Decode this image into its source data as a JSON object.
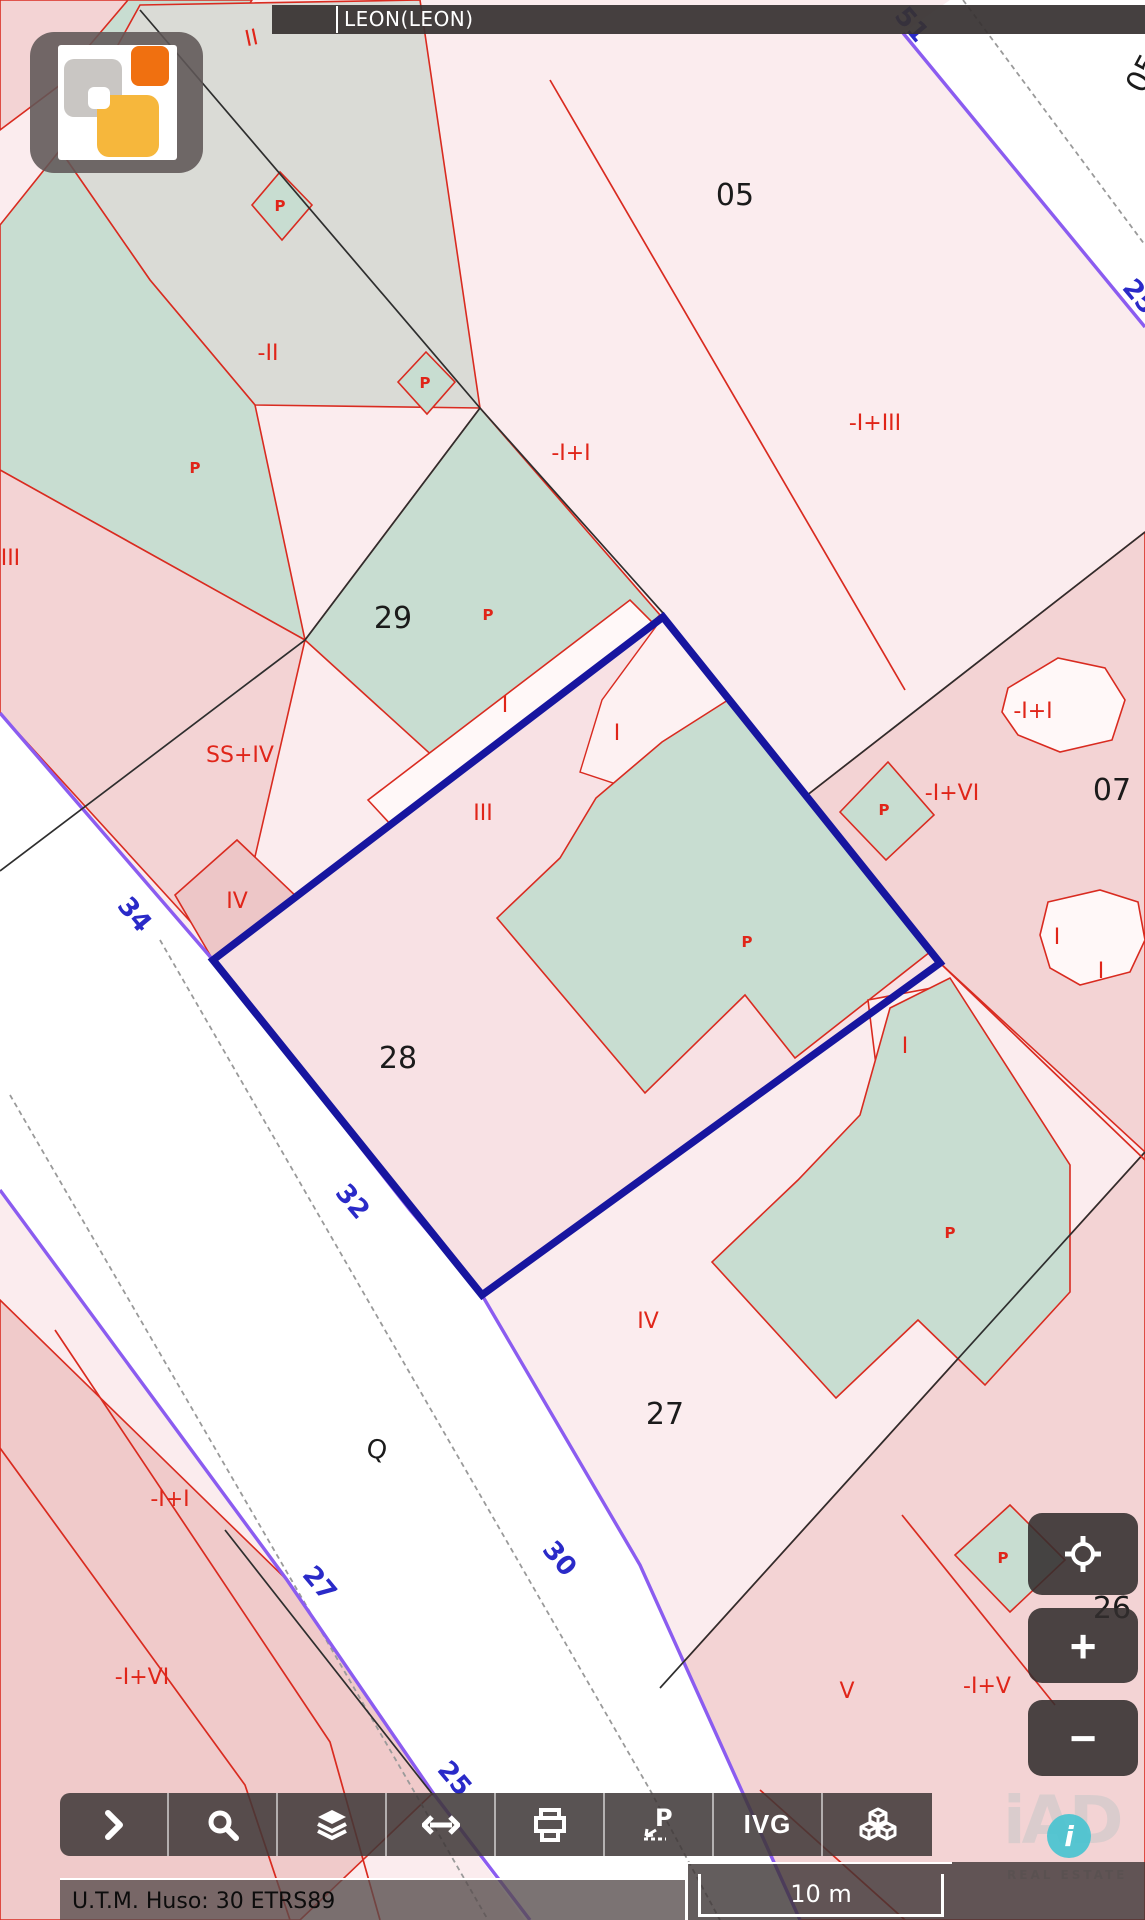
{
  "header": {
    "municipality": "LEON(LEON)"
  },
  "colors": {
    "base_parcel": "#fbecee",
    "rose_parcel": "#f3d3d4",
    "rose_dark": "#edc6c7",
    "green_parcel": "#c8ddd1",
    "gray_parcel": "#dadbd6",
    "street": "#ffffff",
    "red_line": "#d92b20",
    "black_line": "#2e2e2e",
    "purple_line": "#8b5cf0",
    "gray_dash": "#9a9a9a",
    "highlight": "#17159f",
    "parcel_number": "#1b1b1b",
    "construction_label": "#e02519",
    "street_number": "#2a2ac8"
  },
  "map": {
    "labels": [
      {
        "t": "05",
        "x": 735,
        "y": 205,
        "k": "parcel"
      },
      {
        "t": "29",
        "x": 393,
        "y": 628,
        "k": "parcel"
      },
      {
        "t": "28",
        "x": 398,
        "y": 1068,
        "k": "parcel"
      },
      {
        "t": "27",
        "x": 665,
        "y": 1424,
        "k": "parcel"
      },
      {
        "t": "07",
        "x": 1112,
        "y": 800,
        "k": "parcel"
      },
      {
        "t": "26",
        "x": 1112,
        "y": 1618,
        "k": "parcel"
      },
      {
        "t": "05",
        "x": 1152,
        "y": 78,
        "k": "parcel",
        "r": -62
      },
      {
        "t": "Q",
        "x": 375,
        "y": 1458,
        "k": "symbol",
        "r": 12
      },
      {
        "t": "II",
        "x": 253,
        "y": 45,
        "k": "construction",
        "r": -12
      },
      {
        "t": "-II",
        "x": 268,
        "y": 360,
        "k": "construction"
      },
      {
        "t": "-I+I",
        "x": 571,
        "y": 460,
        "k": "construction"
      },
      {
        "t": "-I+III",
        "x": 875,
        "y": 430,
        "k": "construction",
        "s": 24
      },
      {
        "t": "-I+III",
        "x": -6,
        "y": 565,
        "k": "construction"
      },
      {
        "t": "SS+IV",
        "x": 240,
        "y": 762,
        "k": "construction",
        "s": 24
      },
      {
        "t": "IV",
        "x": 237,
        "y": 908,
        "k": "construction",
        "s": 24
      },
      {
        "t": "I",
        "x": 505,
        "y": 712,
        "k": "construction",
        "s": 19
      },
      {
        "t": "I",
        "x": 617,
        "y": 740,
        "k": "construction"
      },
      {
        "t": "III",
        "x": 483,
        "y": 820,
        "k": "construction",
        "s": 24
      },
      {
        "t": "-I+I",
        "x": 1033,
        "y": 718,
        "k": "construction",
        "s": 19
      },
      {
        "t": "-I+VI",
        "x": 952,
        "y": 800,
        "k": "construction"
      },
      {
        "t": "I",
        "x": 905,
        "y": 1053,
        "k": "construction",
        "s": 18
      },
      {
        "t": "I",
        "x": 1057,
        "y": 944,
        "k": "construction",
        "s": 17
      },
      {
        "t": "I",
        "x": 1101,
        "y": 978,
        "k": "construction",
        "s": 17
      },
      {
        "t": "IV",
        "x": 648,
        "y": 1328,
        "k": "construction",
        "s": 24
      },
      {
        "t": "-I+I",
        "x": 170,
        "y": 1506,
        "k": "construction"
      },
      {
        "t": "-I+VI",
        "x": 142,
        "y": 1684,
        "k": "construction"
      },
      {
        "t": "V",
        "x": 847,
        "y": 1698,
        "k": "construction",
        "s": 24
      },
      {
        "t": "-I+V",
        "x": 987,
        "y": 1693,
        "k": "construction"
      },
      {
        "t": "P",
        "x": 280,
        "y": 211,
        "k": "pmark"
      },
      {
        "t": "P",
        "x": 425,
        "y": 388,
        "k": "pmark"
      },
      {
        "t": "P",
        "x": 195,
        "y": 473,
        "k": "pmark"
      },
      {
        "t": "P",
        "x": 488,
        "y": 620,
        "k": "pmark"
      },
      {
        "t": "P",
        "x": 747,
        "y": 947,
        "k": "pmark"
      },
      {
        "t": "P",
        "x": 884,
        "y": 815,
        "k": "pmark"
      },
      {
        "t": "P",
        "x": 950,
        "y": 1238,
        "k": "pmark"
      },
      {
        "t": "P",
        "x": 1003,
        "y": 1563,
        "k": "pmark"
      },
      {
        "t": "34",
        "x": 128,
        "y": 920,
        "k": "street",
        "r": 50
      },
      {
        "t": "32",
        "x": 346,
        "y": 1207,
        "k": "street",
        "r": 50
      },
      {
        "t": "27",
        "x": 313,
        "y": 1589,
        "k": "street",
        "r": 50
      },
      {
        "t": "30",
        "x": 553,
        "y": 1564,
        "k": "street",
        "r": 50
      },
      {
        "t": "25",
        "x": 448,
        "y": 1784,
        "k": "street",
        "r": 50
      },
      {
        "t": "25",
        "x": 1133,
        "y": 302,
        "k": "street",
        "r": 50
      },
      {
        "t": "51",
        "x": 905,
        "y": 30,
        "k": "street",
        "r": 50
      }
    ]
  },
  "controls": {
    "zoom_in": "+",
    "zoom_out": "−"
  },
  "toolbar": {
    "items": [
      {
        "name": "expand-button",
        "icon": "chevron-right-icon",
        "label": ""
      },
      {
        "name": "search-button",
        "icon": "search-icon",
        "label": ""
      },
      {
        "name": "layers-button",
        "icon": "layers-icon",
        "label": ""
      },
      {
        "name": "measure-button",
        "icon": "arrows-horizontal-icon",
        "label": ""
      },
      {
        "name": "print-button",
        "icon": "printer-icon",
        "label": ""
      },
      {
        "name": "point-data-button",
        "icon": "point-p-icon",
        "label": "P"
      },
      {
        "name": "ivg-button",
        "icon": "",
        "label": "IVG"
      },
      {
        "name": "cartography-3d-button",
        "icon": "cubes-icon",
        "label": ""
      }
    ]
  },
  "statusbar": {
    "utm_text": "U.T.M. Huso: 30 ETRS89",
    "scale_label": "10 m"
  },
  "branding": {
    "word": "iAD",
    "info_glyph": "i",
    "tagline": "REAL ESTATE"
  }
}
